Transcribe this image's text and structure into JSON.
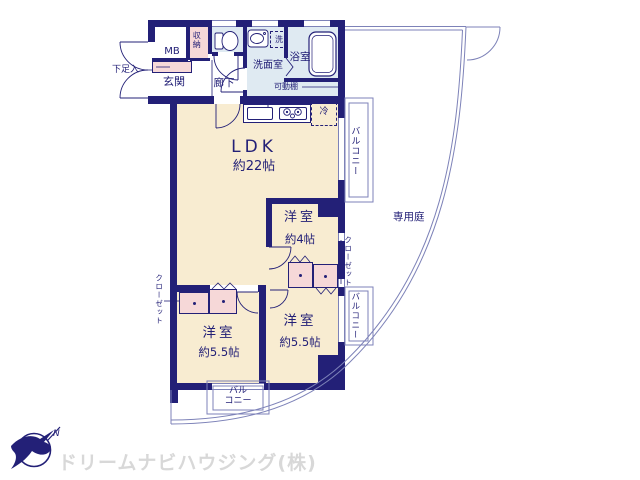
{
  "colors": {
    "wall": "#232077",
    "floor_main": "#f8ecd1",
    "floor_wet": "#dfeaf2",
    "closet_pink": "#f6d8d8",
    "thin_line": "#7d82b8",
    "logo_text_gray": "#d8d8d8",
    "logo_mark_navy": "#232077"
  },
  "plan": {
    "entrance": {
      "label": "玄関",
      "meter_box": "MB",
      "shoe_box": "下足入",
      "storage": "収納",
      "hall": "廊下"
    },
    "wet": {
      "washroom": "洗面室",
      "washer": "洗",
      "bath": "浴室",
      "shelf": "可動棚"
    },
    "ldk": {
      "label": "LDK",
      "size": "約22帖",
      "fridge": "冷"
    },
    "room4": {
      "label": "洋室",
      "size": "約4帖"
    },
    "room55_left": {
      "label": "洋室",
      "size": "約5.5帖"
    },
    "room55_right": {
      "label": "洋室",
      "size": "約5.5帖"
    },
    "closet_left": "クローゼット",
    "closet_right": "クローゼット",
    "balcony_right_top": "バルコニー",
    "balcony_right_mid": "バルコニー",
    "balcony_bottom_line1": "バル",
    "balcony_bottom_line2": "コニー",
    "garden": "専用庭"
  },
  "logo": {
    "company": "ドリームナビハウジング(株)",
    "compass": "N"
  }
}
